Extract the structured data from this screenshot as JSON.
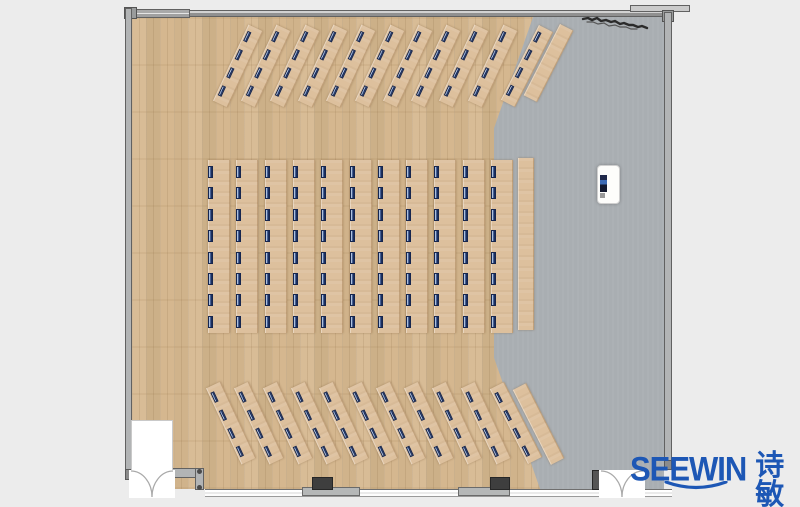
{
  "brand": {
    "name_latin": "SEEWIN",
    "name_cjk": "诗敏"
  },
  "colors": {
    "background": "#ececec",
    "wood_floor": "#d2b48e",
    "desk": "#ddc09d",
    "gray_floor": "#a9aeb2",
    "chair_navy": "#1c2f5e",
    "logo_blue": "#1d57b5",
    "wall_gray": "#b2b4b5"
  },
  "plan": {
    "floors": {
      "left": "wood-plank",
      "right": "gray-stage"
    },
    "groups": [
      {
        "id": "front-angled-row",
        "desk_count": 11,
        "seats_per_desk": 4,
        "angle_deg": 25,
        "side_tables": 1
      },
      {
        "id": "center-columns",
        "desk_count": 11,
        "seats_per_desk": 8,
        "angle_deg": 0,
        "side_tables": 1
      },
      {
        "id": "back-angled-row",
        "desk_count": 11,
        "seats_per_desk": 4,
        "angle_deg": -25,
        "side_tables": 1
      }
    ],
    "total_seats": 176,
    "podium_count": 1,
    "doors": [
      {
        "location": "bottom-left",
        "type": "double-swing"
      },
      {
        "location": "bottom-right",
        "type": "double-swing"
      }
    ]
  }
}
